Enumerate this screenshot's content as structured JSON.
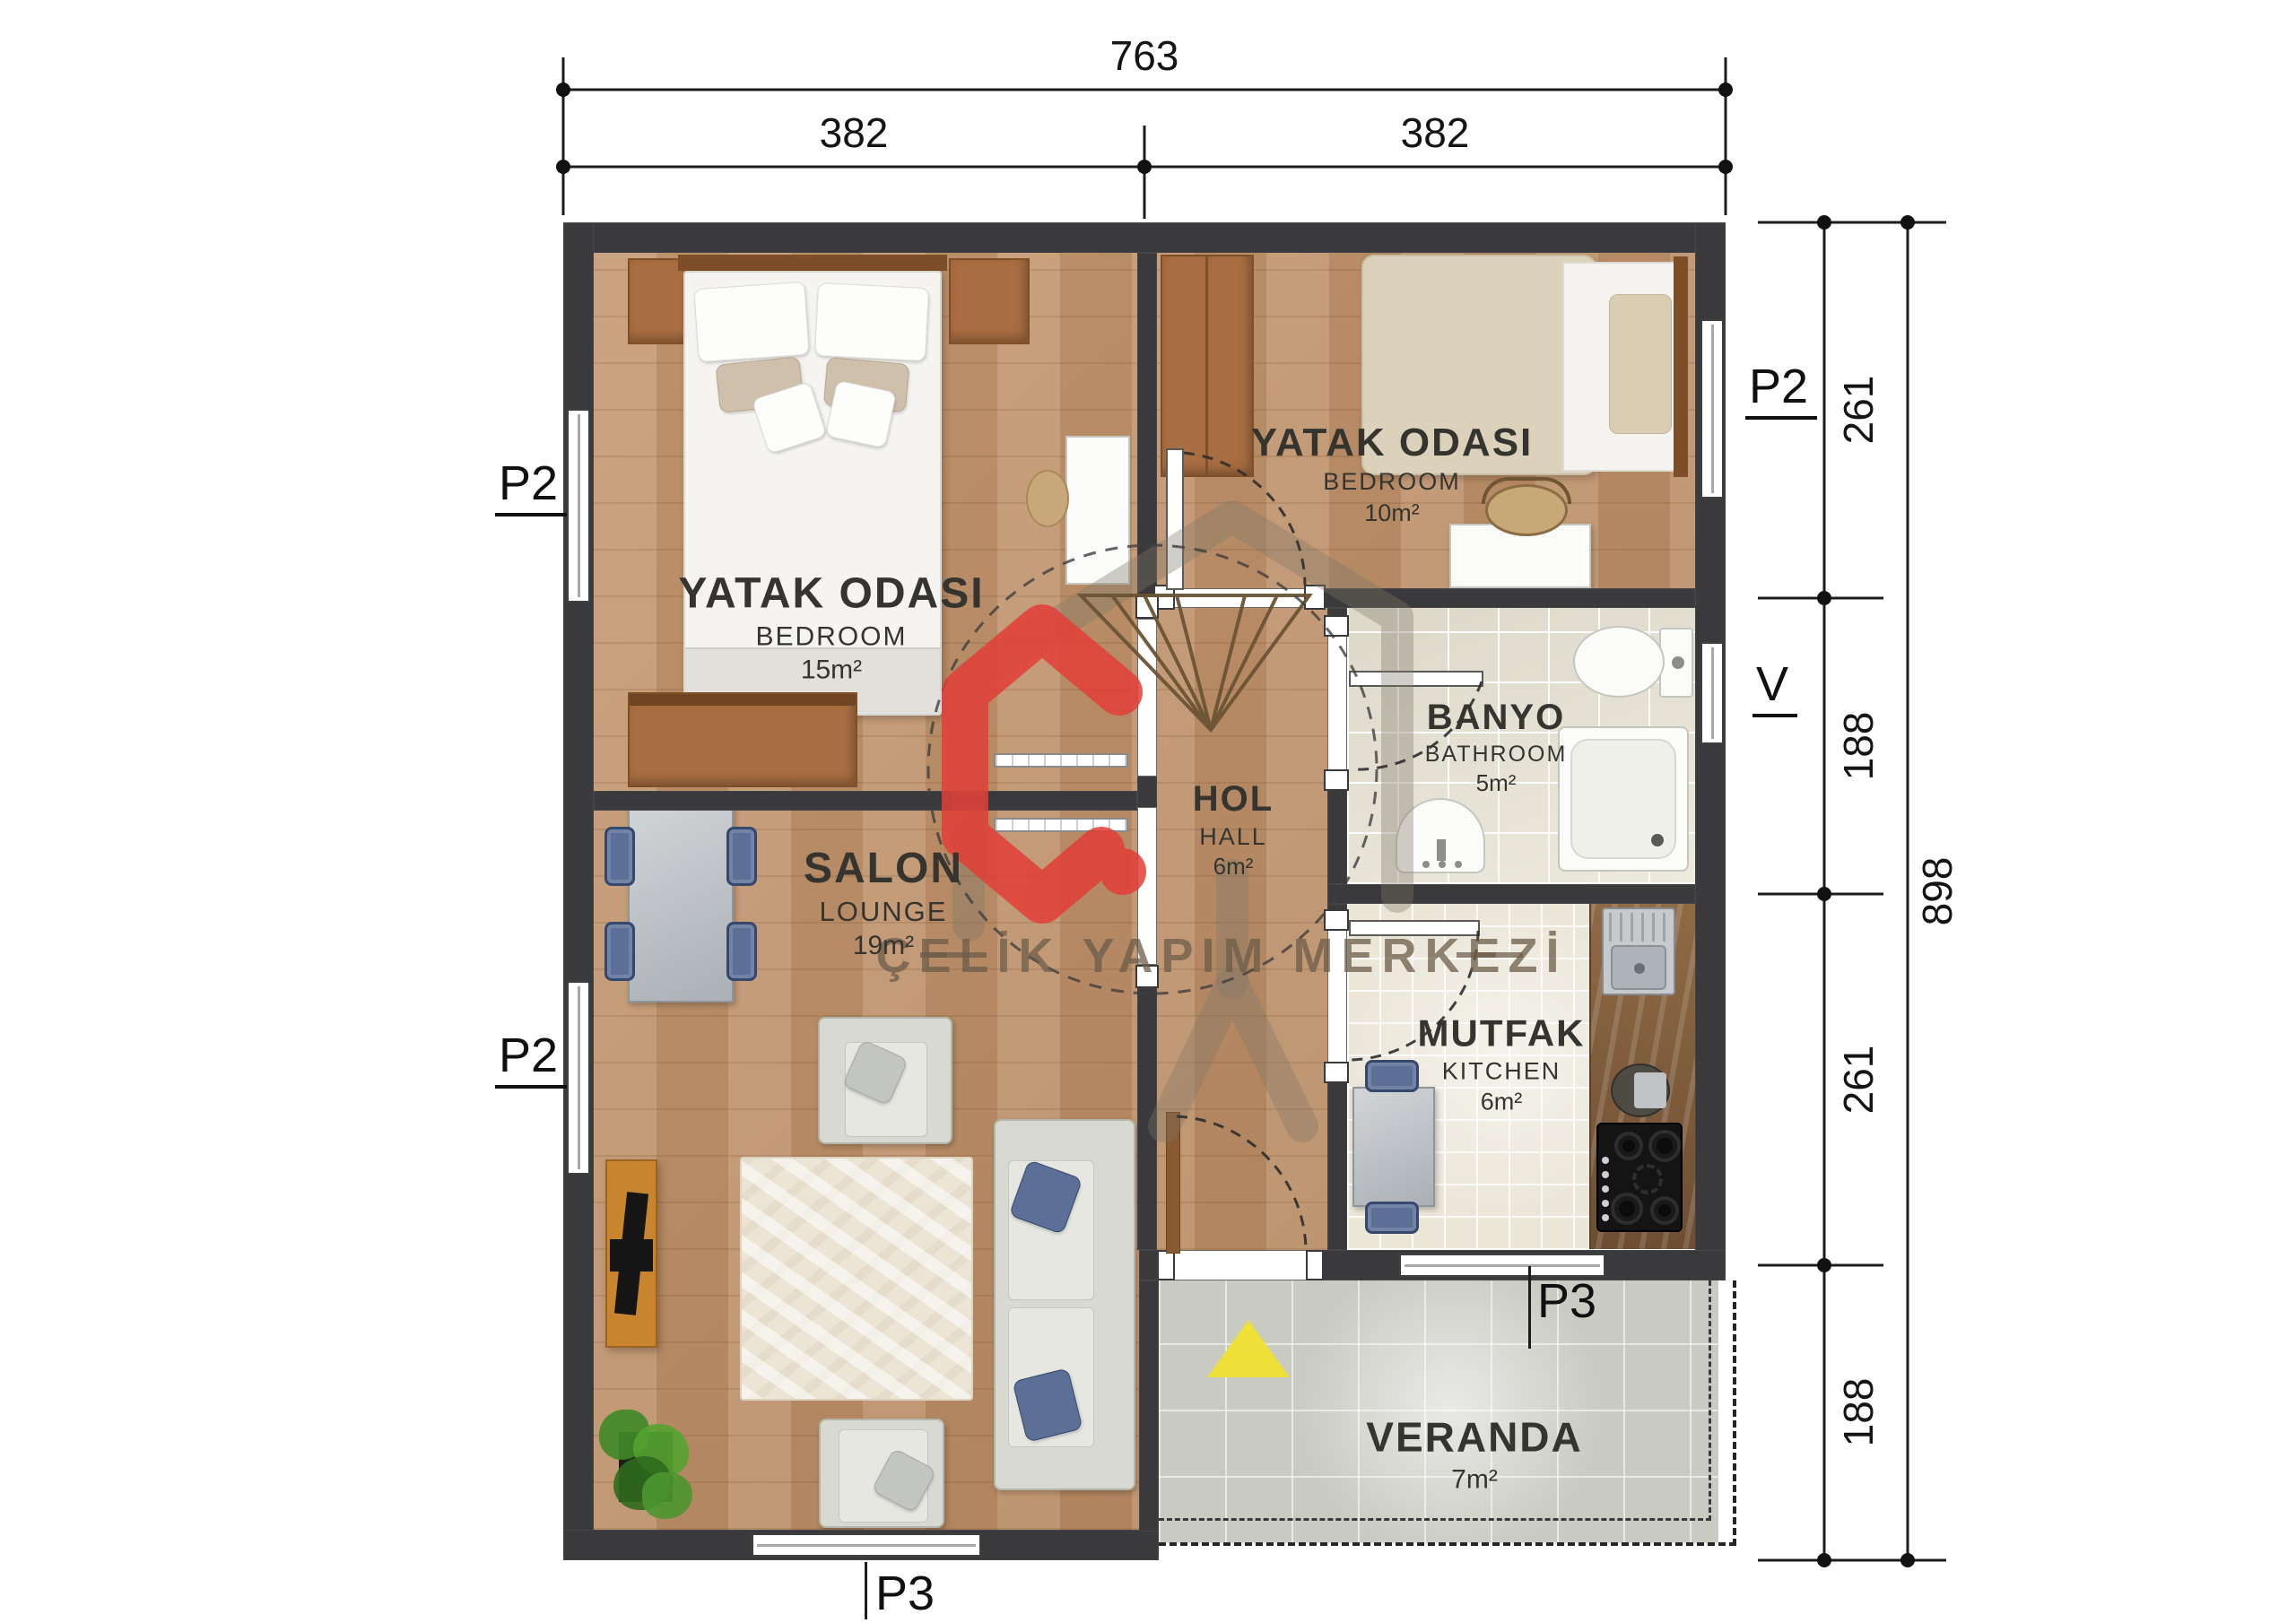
{
  "colors": {
    "wall": "#3a3a3c",
    "wood_floor": "#c09066",
    "bath_tile": "#e8e4d5",
    "kitchen_tile": "#ebe6d8",
    "veranda_tile": "#c9cbc2",
    "logo_red": "#e23f38",
    "marker_yellow": "#efe039"
  },
  "dimensions": {
    "top_total": "763",
    "top_left": "382",
    "top_right": "382",
    "right_seg_1": "261",
    "right_seg_2": "188",
    "right_seg_3": "261",
    "right_seg_4": "188",
    "right_total": "898"
  },
  "markers": {
    "p2": "P2",
    "p3": "P3",
    "v": "V"
  },
  "rooms": {
    "bedroom_left": {
      "title": "YATAK ODASI",
      "subtitle": "BEDROOM",
      "area": "15m²"
    },
    "bedroom_right": {
      "title": "YATAK ODASI",
      "subtitle": "BEDROOM",
      "area": "10m²"
    },
    "salon": {
      "title": "SALON",
      "subtitle": "LOUNGE",
      "area": "19m²"
    },
    "hall": {
      "title": "HOL",
      "subtitle": "HALL",
      "area": "6m²"
    },
    "bathroom": {
      "title": "BANYO",
      "subtitle": "BATHROOM",
      "area": "5m²"
    },
    "kitchen": {
      "title": "MUTFAK",
      "subtitle": "KITCHEN",
      "area": "6m²"
    },
    "veranda": {
      "title": "VERANDA",
      "area": "7m²"
    }
  },
  "watermark": {
    "text": "ÇELİK YAPIM MERKEZİ"
  }
}
